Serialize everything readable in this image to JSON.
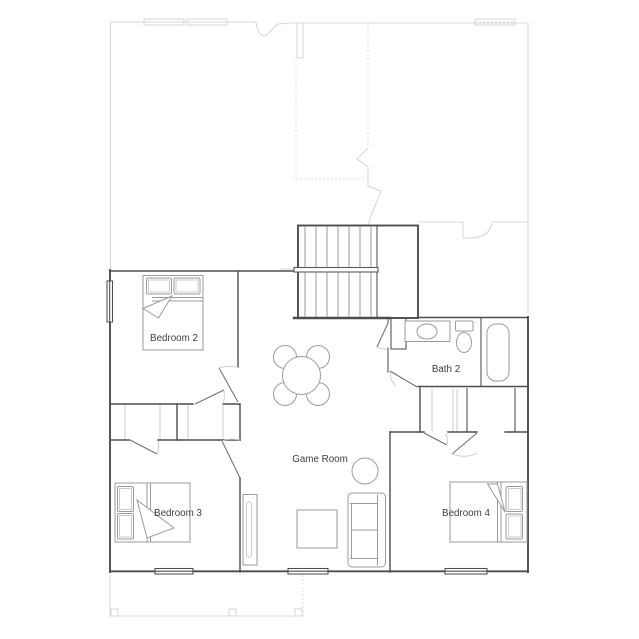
{
  "plan": {
    "rooms": {
      "bedroom2": {
        "label": "Bedroom 2"
      },
      "bedroom3": {
        "label": "Bedroom 3"
      },
      "bedroom4": {
        "label": "Bedroom 4"
      },
      "bath2": {
        "label": "Bath 2"
      },
      "gameroom": {
        "label": "Game Room"
      }
    },
    "colors": {
      "wall": "#4d4d4d",
      "furniture": "#9b9b9b",
      "lower_level": "#d8d8d8",
      "label_text": "#3d3d3d",
      "background": "#ffffff"
    }
  }
}
